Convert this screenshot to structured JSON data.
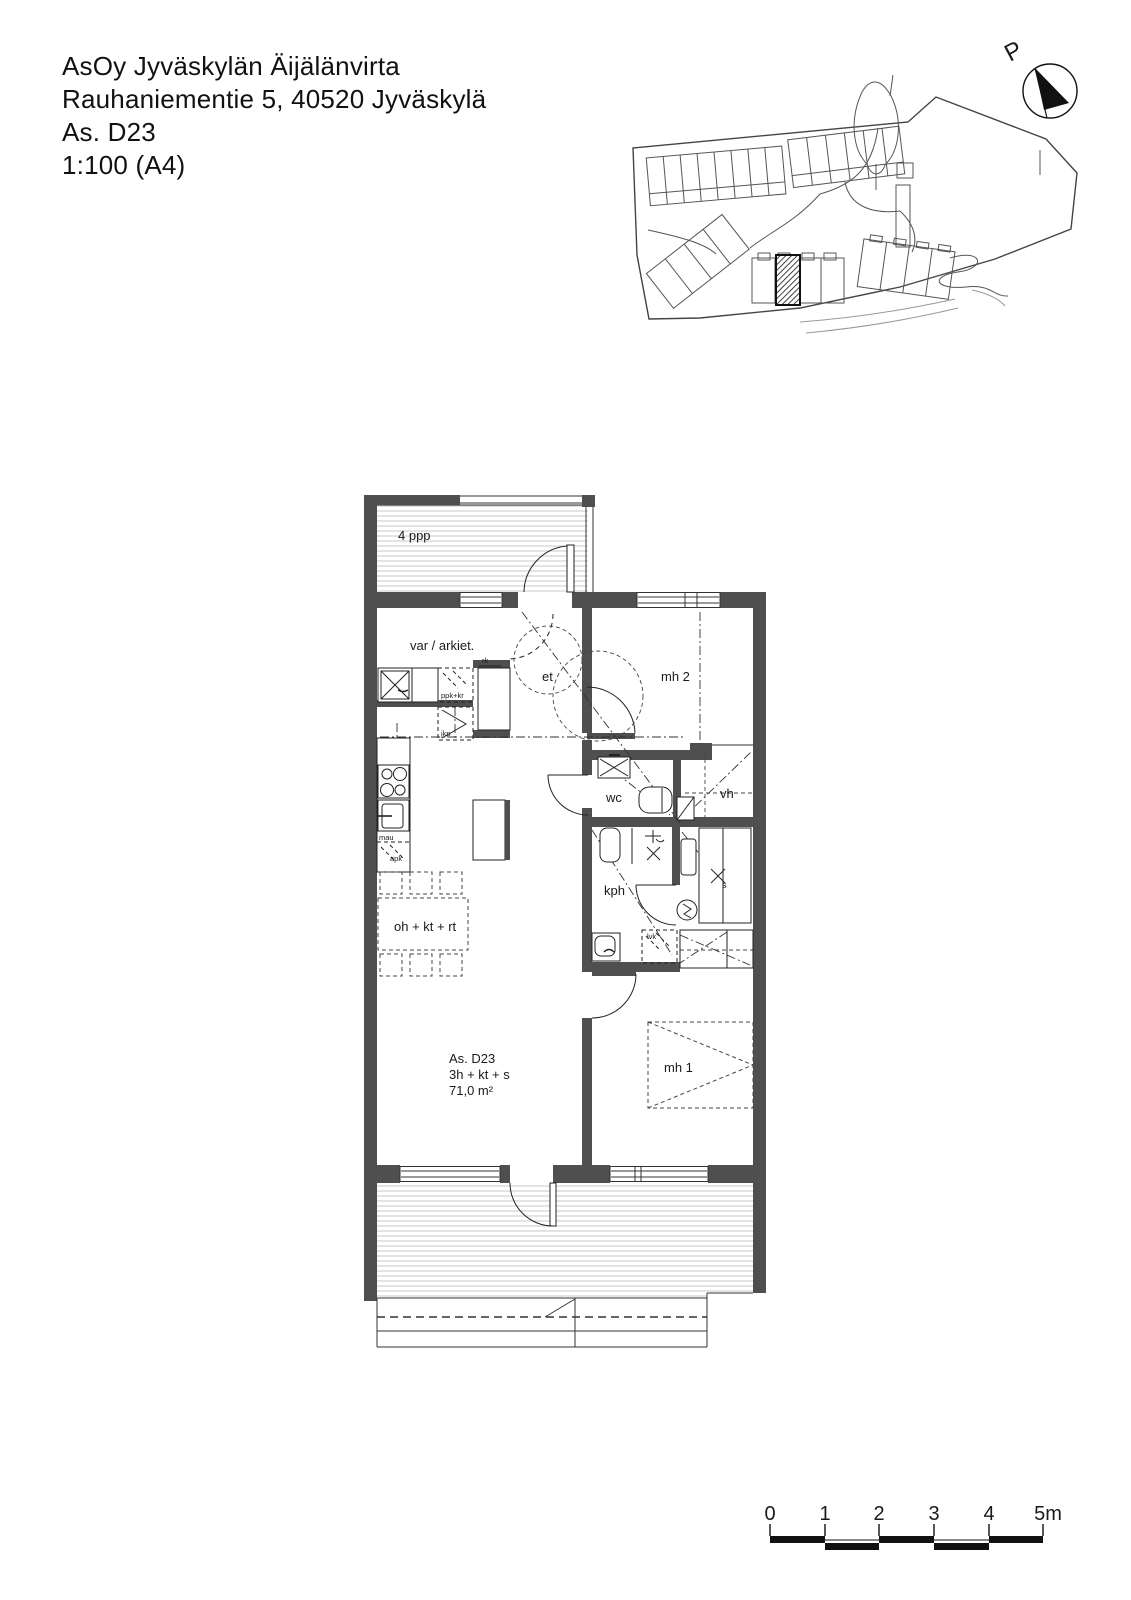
{
  "header": {
    "project": "AsOy Jyväskylän Äijälänvirta",
    "address": "Rauhaniementie 5, 40520 Jyväskylä",
    "apartment": "As. D23",
    "scale": "1:100 (A4)"
  },
  "north_arrow": {
    "label": "P"
  },
  "floor_plan": {
    "rooms": {
      "balcony": "4 ppp",
      "storage": "var / arkiet.",
      "entry": "et",
      "bedroom2": "mh 2",
      "wc": "wc",
      "walkin_closet": "vh",
      "bathroom": "kph",
      "living_kitchen": "oh + kt + rt",
      "bedroom1": "mh 1"
    },
    "apartment_info": {
      "id": "As. D23",
      "layout": "3h + kt + s",
      "area": "71,0 m²"
    },
    "equipment": {
      "washer_dryer": "ppk+kr",
      "fridge_freezer": "jkp",
      "cabinet": "rk",
      "microwave": "mau",
      "dishwasher": "apk",
      "water_heater": "lvk",
      "sauna_mark": "s"
    }
  },
  "scale_bar": {
    "labels": [
      "0",
      "1",
      "2",
      "3",
      "4",
      "5m"
    ]
  },
  "colors": {
    "wall_fill": "#4f4f4f",
    "line": "#222222",
    "deck_stripe": "#c8c8c8"
  }
}
